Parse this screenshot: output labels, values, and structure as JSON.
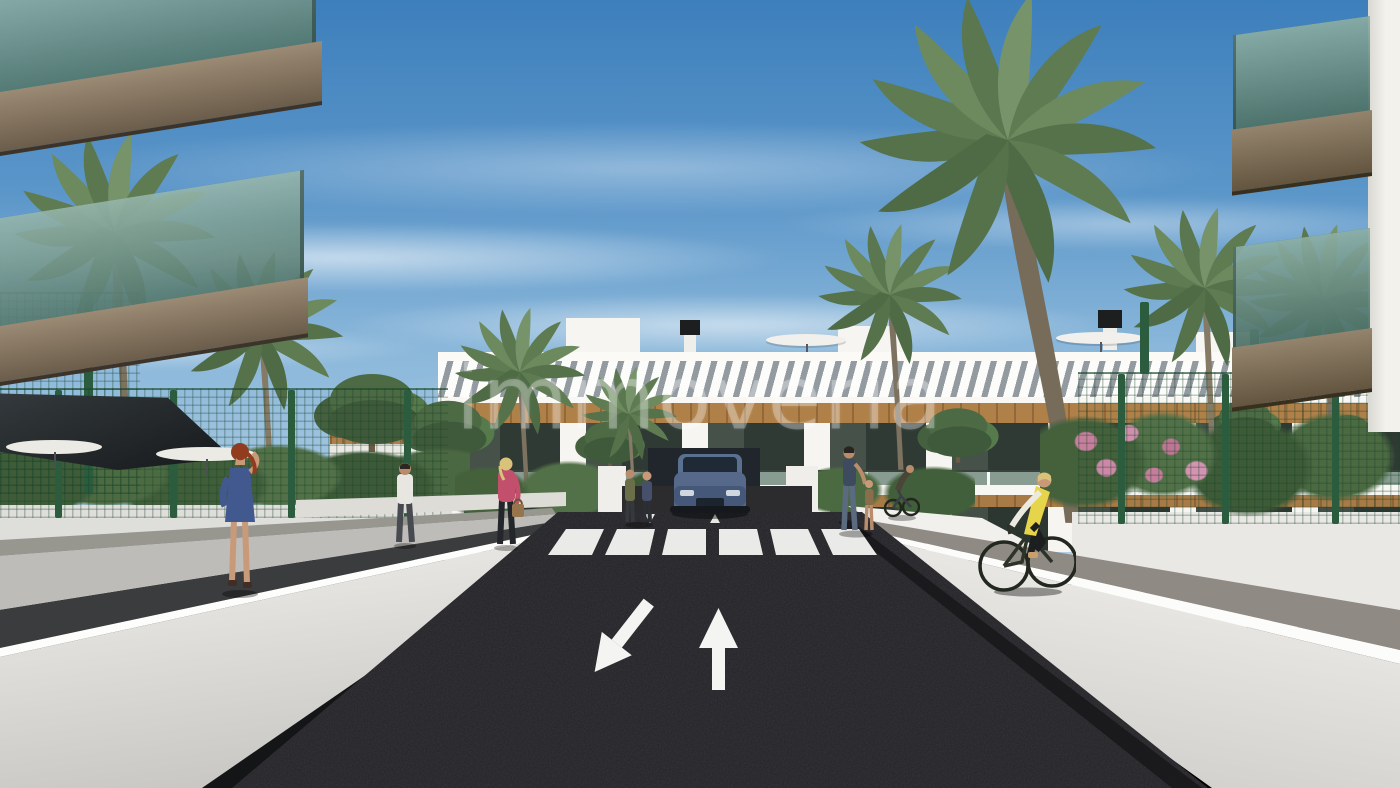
{
  "watermark": {
    "text": "immoveria"
  },
  "scene": {
    "type": "architectural-rendering",
    "subject": "Street-level render of a new-build white apartment complex with palm trees, green mesh fences, pedestrians, a cyclist in a yellow vest and a car at the road end",
    "road_markings": {
      "crosswalk_stripes": 6,
      "lane_toward_viewer_arrow": "down-left-arrow",
      "lane_away_arrow": "up-arrow"
    }
  },
  "colors": {
    "sky_top": "#3d7fbc",
    "sky_horizon": "#b3cfe4",
    "asphalt": "#232327",
    "building_white": "#f2f1ed",
    "wood_trim": "#b08049",
    "glass_green": "#7ba595",
    "fence_green": "#2a5c3d",
    "vest_yellow": "#e6d44b",
    "dress_blue": "#41598f",
    "top_pink": "#c2506d",
    "soffit_brown": "#8d7c64"
  }
}
